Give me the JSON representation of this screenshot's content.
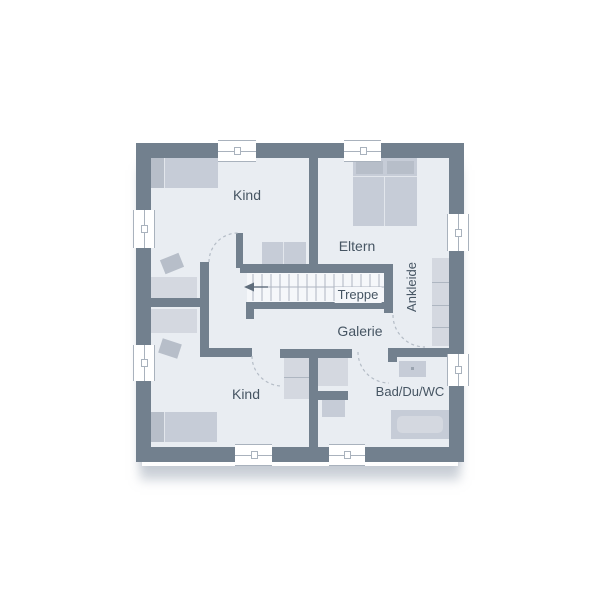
{
  "rooms": [
    {
      "id": "kind-top",
      "label": "Kind"
    },
    {
      "id": "eltern",
      "label": "Eltern"
    },
    {
      "id": "treppe",
      "label": "Treppe"
    },
    {
      "id": "galerie",
      "label": "Galerie"
    },
    {
      "id": "ankleide",
      "label": "Ankleide"
    },
    {
      "id": "bad-du-wc",
      "label": "Bad/Du/WC"
    },
    {
      "id": "kind-bottom",
      "label": "Kind"
    }
  ],
  "symbols": {
    "stair_direction_arrow": "points-left",
    "door_swing_arcs": 4,
    "windows": 8
  },
  "colors": {
    "wall": "#72808e",
    "floor": "#e9edf2",
    "stairs": "#f5f7fa",
    "furniture": "#c6ccd7",
    "furniture-dark": "#b7bec9",
    "furniture-light": "#d4d8e0",
    "line": "#a9b2bd",
    "text": "#465563",
    "arc": "#b4bcc6"
  }
}
